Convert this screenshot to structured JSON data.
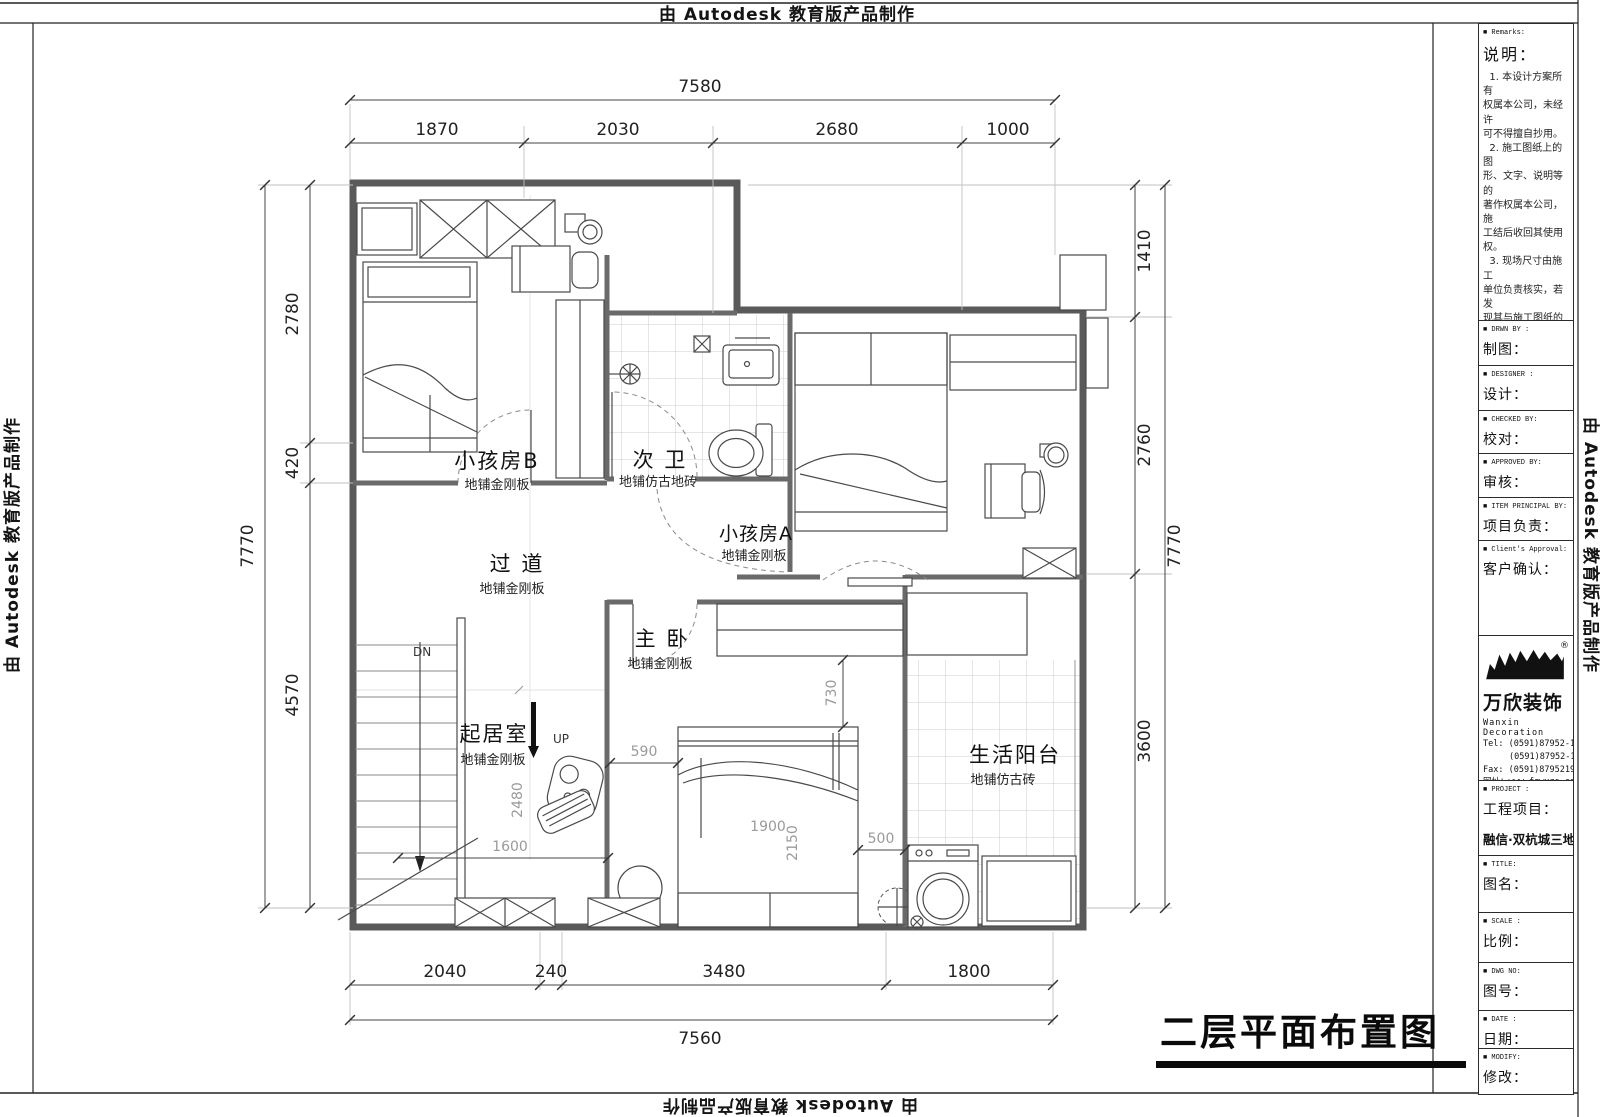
{
  "banners": {
    "autodesk": "由 Autodesk 教育版产品制作"
  },
  "drawing_title": "二层平面布置图",
  "plan": {
    "rooms": [
      {
        "name": "小孩房B",
        "floor": "地铺金刚板"
      },
      {
        "name": "次 卫",
        "floor": "地铺仿古地砖"
      },
      {
        "name": "小孩房A",
        "floor": "地铺金刚板"
      },
      {
        "name": "过 道",
        "floor": "地铺金刚板"
      },
      {
        "name": "主 卧",
        "floor": "地铺金刚板"
      },
      {
        "name": "起居室",
        "floor": "地铺金刚板"
      },
      {
        "name": "生活阳台",
        "floor": "地铺仿古砖"
      }
    ],
    "stairs": {
      "up": "UP",
      "down": "DN"
    },
    "dims": {
      "top_total": "7580",
      "top": [
        "1870",
        "2030",
        "2680",
        "1000"
      ],
      "left_total": "7770",
      "left": [
        "2780",
        "420",
        "4570"
      ],
      "right_total": "7770",
      "right": [
        "1410",
        "2760",
        "3600"
      ],
      "bottom_total": "7560",
      "bottom": [
        "2040",
        "240",
        "3480",
        "1800"
      ],
      "interior": [
        "590",
        "730",
        "1900",
        "2150",
        "500",
        "2480",
        "1600"
      ]
    }
  },
  "title_block": {
    "remarks": {
      "tag": "■ Remarks:",
      "label": "说明：",
      "body": "  1. 本设计方案所有\n权属本公司，未经许\n可不得擅自抄用。\n  2. 施工图纸上的图\n形、文字、说明等的\n著作权属本公司，施\n工结后收回其使用权。\n  3. 现场尺寸由施工\n单位负责核实，若发\n现其与施工图纸的标\n注有出入等，施工单\n位有责任立即通知本\n公司，否则施工单位\n须承担所有责任。\n  4. 本设计方案是依\n客户要求设计，经客\n户签字即视为同意认\n可，不得随意更改。"
    },
    "fields": [
      {
        "tag": "■ DRWN  BY :",
        "label": "制图："
      },
      {
        "tag": "■ DESIGNER :",
        "label": "设计："
      },
      {
        "tag": "■ CHECKED  BY:",
        "label": "校对："
      },
      {
        "tag": "■ APPROVED  BY:",
        "label": "审核："
      },
      {
        "tag": "■ ITEM PRINCIPAL BY:",
        "label": "项目负责："
      },
      {
        "tag": "■ Client's Approval:",
        "label": "客户确认："
      }
    ],
    "company": {
      "name": "万欣装饰",
      "reg": "®",
      "en": "Wanxin Decoration",
      "tel1": "Tel: (0591)87952-166",
      "tel2": "(0591)87952-177",
      "fax": "Fax: (0591)87952199",
      "web": "网址：www.fzwxzs.com"
    },
    "project": {
      "tag": "■ PROJECT :",
      "label": "工程项目：",
      "value": "融信·双杭城三地块"
    },
    "fields2": [
      {
        "tag": "■ TITLE:",
        "label": "图名："
      },
      {
        "tag": "■ SCALE :",
        "label": "比例："
      },
      {
        "tag": "■ DWG NO:",
        "label": "图号："
      },
      {
        "tag": "■ DATE :",
        "label": "日期："
      },
      {
        "tag": "■ MODIFY:",
        "label": "修改："
      }
    ]
  }
}
